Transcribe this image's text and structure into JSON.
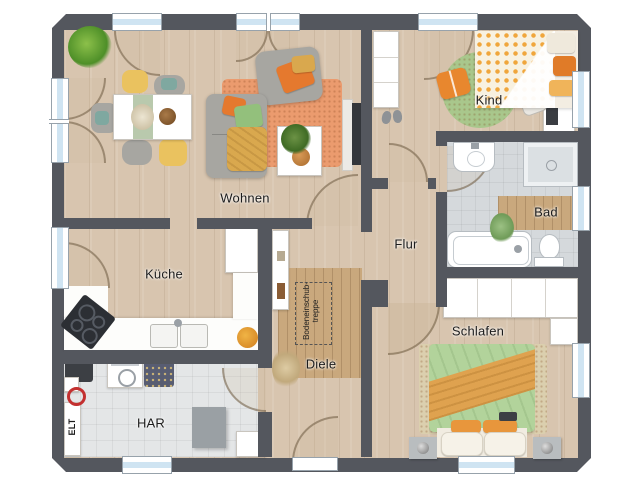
{
  "rooms": [
    {
      "id": "wohnen",
      "label": "Wohnen"
    },
    {
      "id": "kind",
      "label": "Kind"
    },
    {
      "id": "bad",
      "label": "Bad"
    },
    {
      "id": "flur",
      "label": "Flur"
    },
    {
      "id": "kueche",
      "label": "Küche"
    },
    {
      "id": "diele",
      "label": "Diele"
    },
    {
      "id": "schlafen",
      "label": "Schlafen"
    },
    {
      "id": "har",
      "label": "HAR"
    }
  ],
  "annotations": {
    "elt": "ELT",
    "attic_stairs_line1": "Bodeneinschub-",
    "attic_stairs_line2": "treppe"
  },
  "colors": {
    "wall": "#54575e",
    "wood": "#d8c5af",
    "mat": "#c9a87d",
    "tile-bad": "#d5d9dc",
    "tile-har": "#e4e6e7",
    "glass": "#cfe4f2",
    "rug-orange": "#eb9b6e",
    "rug-green": "#a9c78c",
    "rug-beige": "#dbcfae",
    "sofa-gray": "#a7a6a1",
    "chair-yellow": "#eac25f",
    "pillow-orange": "#e5792e",
    "pillow-green": "#93c07c",
    "throw-mustard": "#d9a84e",
    "duvet-green": "#b2d39b",
    "blanket-orange": "#dfa24f",
    "kind-duvet-dot": "#f0a63c"
  }
}
